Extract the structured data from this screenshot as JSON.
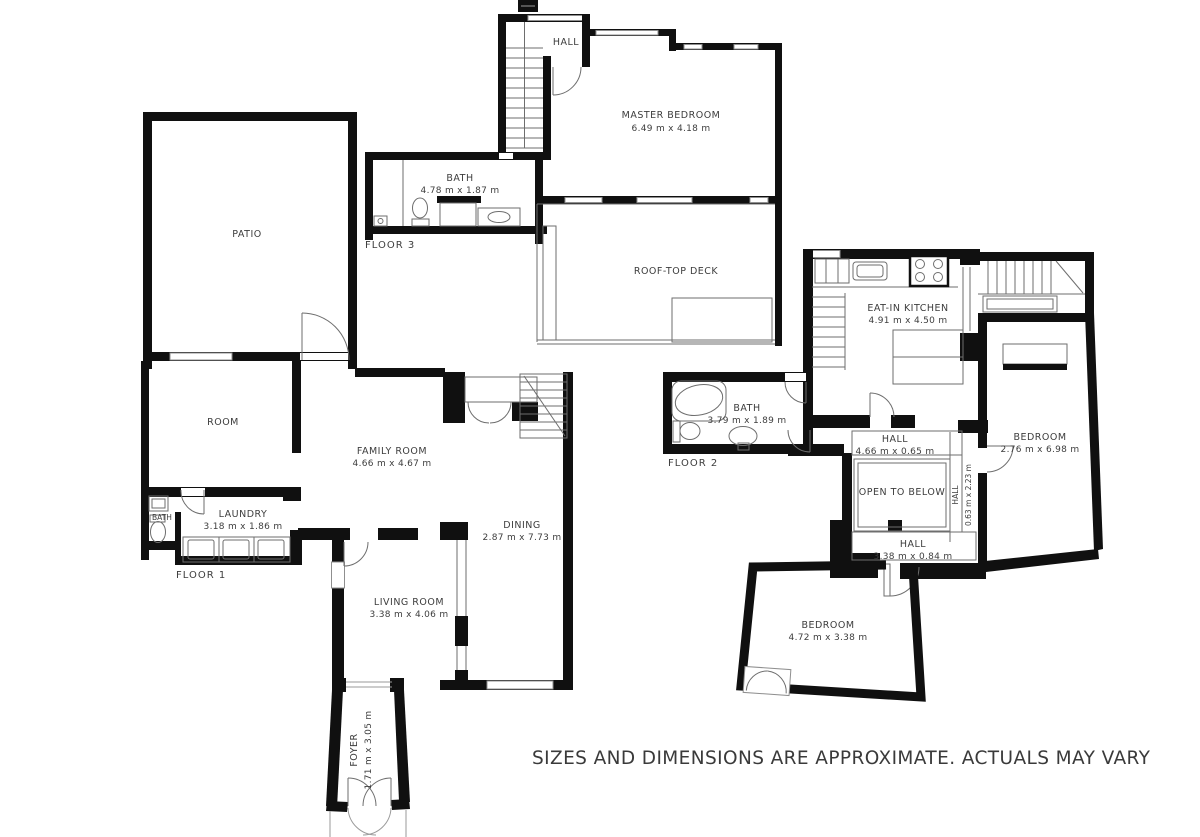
{
  "disclaimer": "SIZES AND DIMENSIONS ARE APPROXIMATE. ACTUALS MAY VARY",
  "floor_labels": {
    "floor1": "FLOOR 1",
    "floor2": "FLOOR 2",
    "floor3": "FLOOR 3"
  },
  "rooms": {
    "hall_f3": {
      "name": "HALL"
    },
    "master_bedroom": {
      "name": "MASTER BEDROOM",
      "dims": "6.49 m x 4.18 m"
    },
    "bath_f3": {
      "name": "BATH",
      "dims": "4.78 m x 1.87 m"
    },
    "roof_top_deck": {
      "name": "ROOF-TOP DECK"
    },
    "patio": {
      "name": "PATIO"
    },
    "room": {
      "name": "ROOM"
    },
    "family_room": {
      "name": "FAMILY ROOM",
      "dims": "4.66 m x 4.67 m"
    },
    "laundry": {
      "name": "LAUNDRY",
      "dims": "3.18 m x 1.86 m"
    },
    "bath_f1": {
      "name": "BATH"
    },
    "dining": {
      "name": "DINING",
      "dims": "2.87 m x 7.73 m"
    },
    "living_room": {
      "name": "LIVING ROOM",
      "dims": "3.38 m x 4.06 m"
    },
    "foyer": {
      "name": "FOYER",
      "dims": "1.71 m x 3.05 m"
    },
    "eat_in_kitchen": {
      "name": "EAT-IN KITCHEN",
      "dims": "4.91 m x 4.50 m"
    },
    "bath_f2": {
      "name": "BATH",
      "dims": "3.79 m x 1.89 m"
    },
    "hall_upper_f2": {
      "name": "HALL",
      "dims": "4.66 m x 0.65 m"
    },
    "bedroom_f2": {
      "name": "BEDROOM",
      "dims": "2.76 m x 6.98 m"
    },
    "open_to_below": {
      "name": "OPEN TO BELOW"
    },
    "hall_vertical_f2": {
      "name": "HALL",
      "dims": "0.63 m x 2.23 m"
    },
    "hall_lower_f2": {
      "name": "HALL",
      "dims": "3.38 m x 0.84 m"
    },
    "bedroom_lower": {
      "name": "BEDROOM",
      "dims": "4.72 m x 3.38 m"
    }
  },
  "colors": {
    "wall": "#101010",
    "line": "#6e6e6e",
    "text": "#3d3d3d",
    "background": "#ffffff"
  }
}
